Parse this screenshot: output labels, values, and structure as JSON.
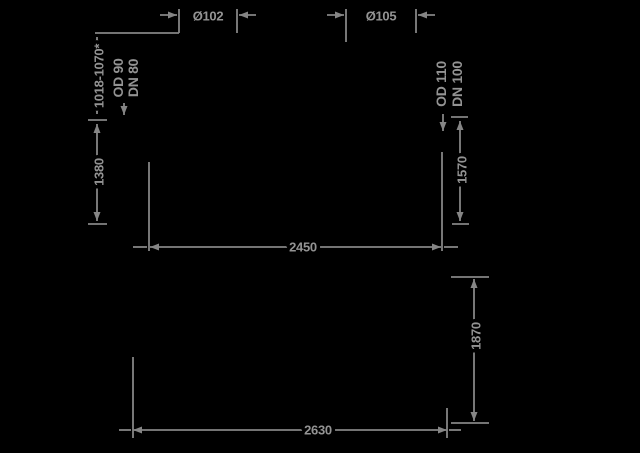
{
  "colors": {
    "background": "#000000",
    "line": "#858585",
    "text": "#939393"
  },
  "upper_view": {
    "left_nozzle": {
      "hole_dim": "Ø102",
      "size_line1": "OD 90",
      "size_line2": "DN 80"
    },
    "right_nozzle": {
      "hole_dim": "Ø105",
      "size_line1": "OD 110",
      "size_line2": "DN 100"
    },
    "height_range": "1018-1070*",
    "height_left": "1380",
    "height_right": "1570",
    "width": "2450"
  },
  "lower_view": {
    "height": "1870",
    "width": "2630"
  }
}
